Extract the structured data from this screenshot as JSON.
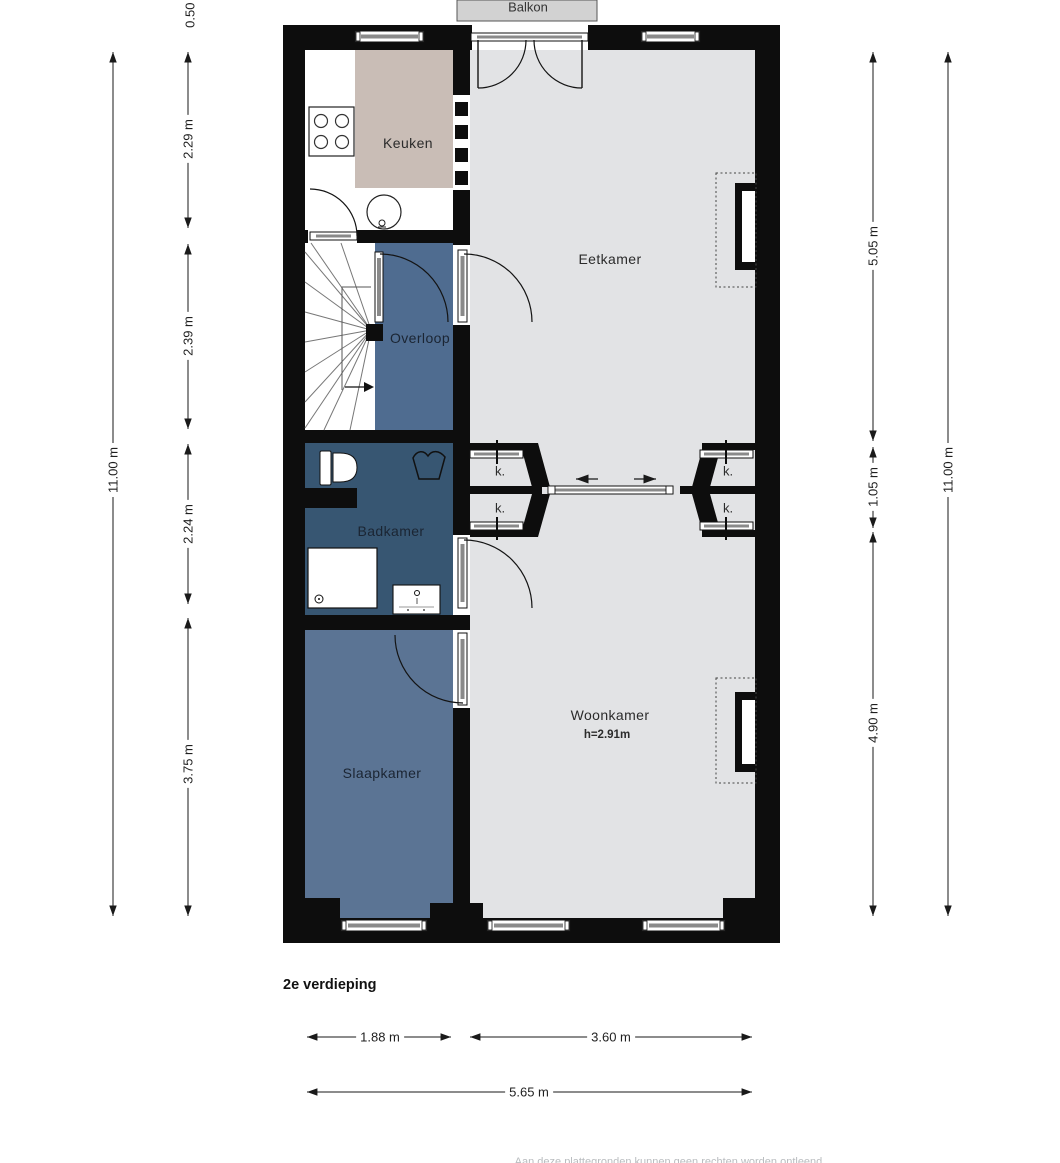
{
  "page": {
    "floor_title": "2e verdieping",
    "footer_note": "Aan deze plattegronden kunnen geen rechten worden ontleend."
  },
  "balcony": {
    "label": "Balkon"
  },
  "rooms": {
    "keuken": {
      "label": "Keuken"
    },
    "eetkamer": {
      "label": "Eetkamer"
    },
    "overloop": {
      "label": "Overloop"
    },
    "badkamer": {
      "label": "Badkamer"
    },
    "slaapkamer": {
      "label": "Slaapkamer"
    },
    "woonkamer": {
      "label": "Woonkamer",
      "ceiling_height": "h=2.91m"
    }
  },
  "closets": {
    "label": "k."
  },
  "dimensions": {
    "left_outer": "11.00 m",
    "balcony_depth_partial": "0.50 m",
    "left_segments": [
      "2.29 m",
      "2.39 m",
      "2.24 m",
      "3.75 m"
    ],
    "right_segments": [
      "5.05 m",
      "1.05 m",
      "4.90 m"
    ],
    "right_outer": "11.00 m",
    "bottom_segments": [
      "1.88 m",
      "3.60 m"
    ],
    "bottom_total": "5.65 m"
  },
  "colors": {
    "wall": "#0d0d0d",
    "floor_light": "#e2e3e5",
    "keuken_accent": "#c9bdb6",
    "overloop_blue": "#4f6c90",
    "badkamer_blue": "#375672",
    "slaapkamer_blue": "#5b7494",
    "balkon_gray": "#d2d2d2"
  }
}
